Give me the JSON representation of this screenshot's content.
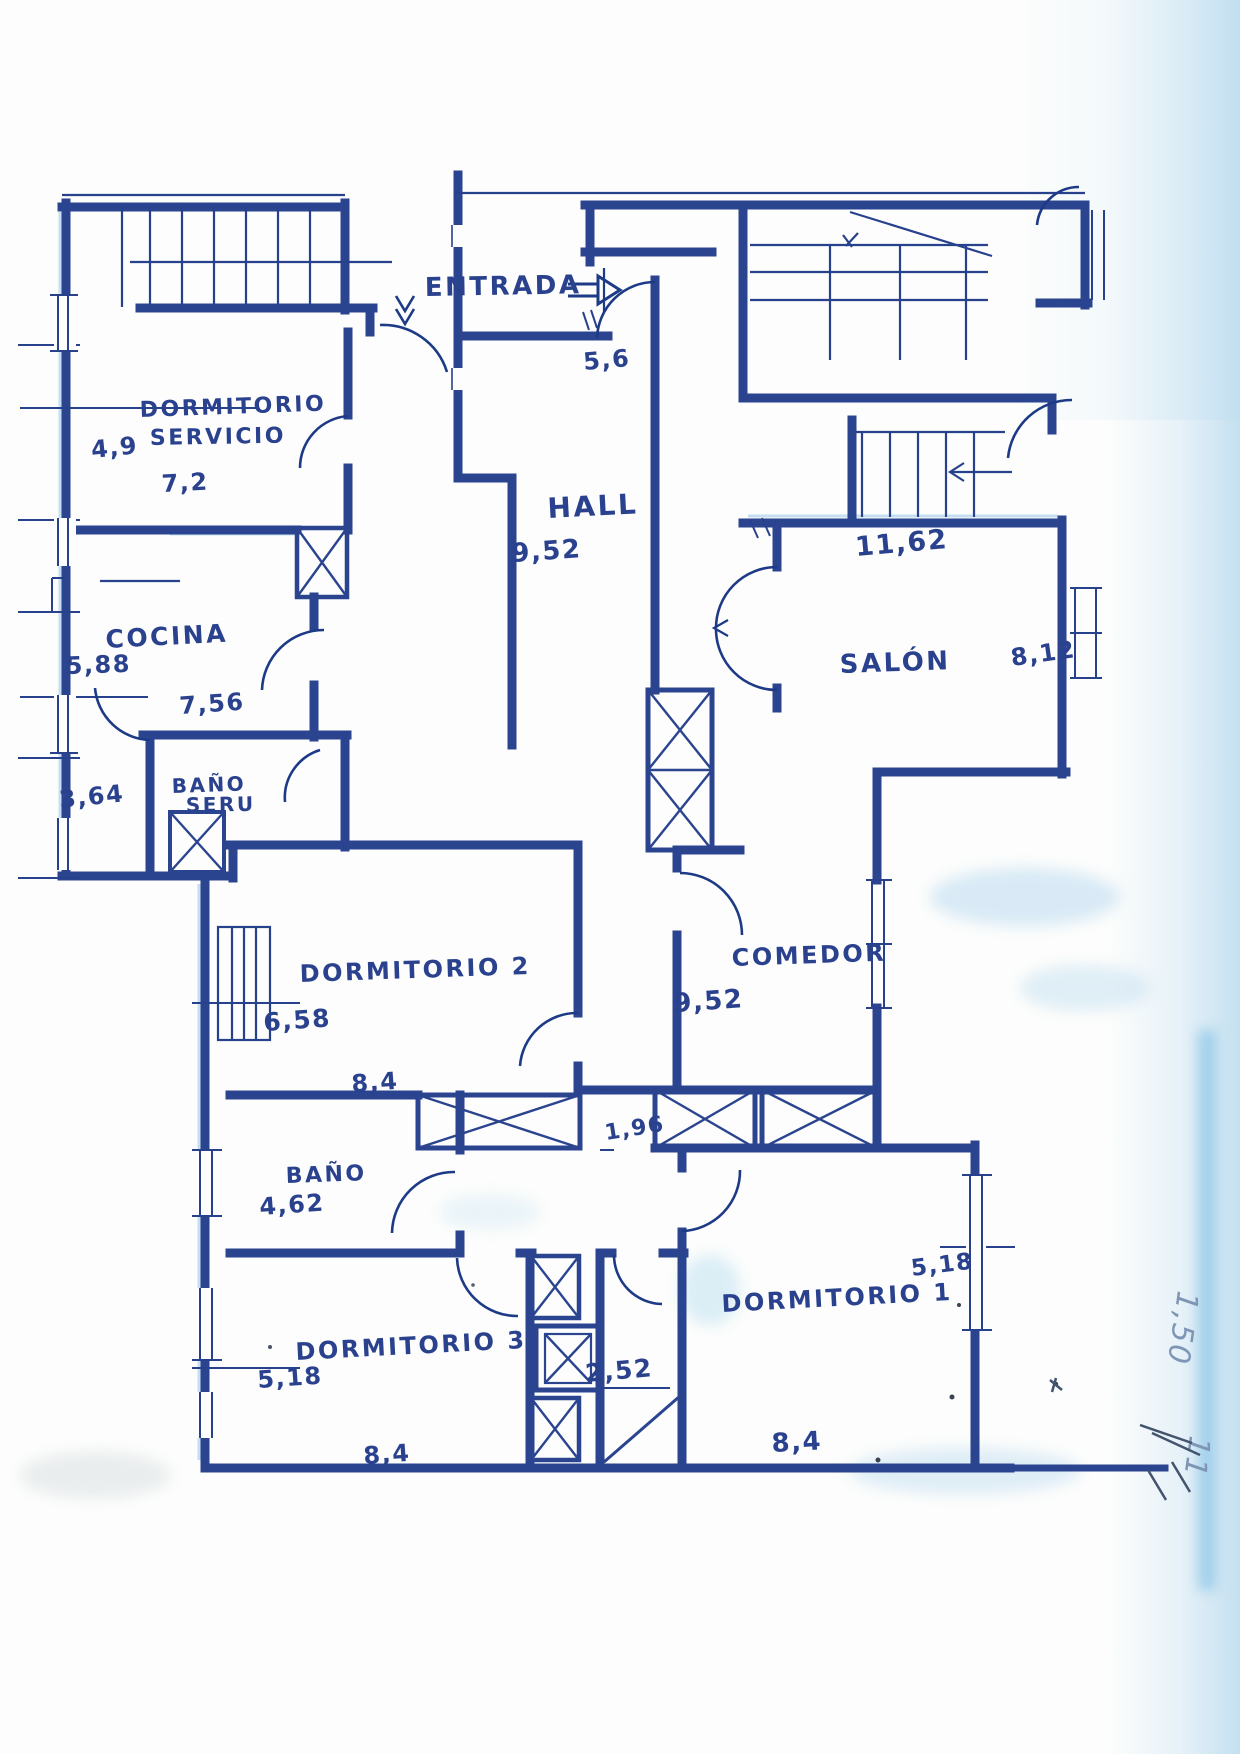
{
  "plan": {
    "rooms": {
      "dormitorio_servicio": {
        "label_line1": "DORMITORIO",
        "label_line2": "SERVICIO",
        "dim_width": "4,9",
        "dim_length": "7,2"
      },
      "cocina": {
        "label": "COCINA",
        "dim_width": "5,88",
        "dim_length": "7,56"
      },
      "bano_servicio": {
        "label_line1": "BAÑO",
        "label_line2": "SERU",
        "dim_width": "3,64"
      },
      "entrada": {
        "label": "ENTRADA",
        "dim_width": "5,6"
      },
      "hall": {
        "label": "HALL",
        "dim_length": "9,52"
      },
      "salon": {
        "label": "SALÓN",
        "dim_width": "11,62",
        "dim_depth": "8,12"
      },
      "comedor": {
        "label": "COMEDOR",
        "dim_length": "9,52",
        "dim_corridor": "1,96"
      },
      "dormitorio_2": {
        "label": "DORMITORIO 2",
        "dim_width": "6,58",
        "dim_length": "8,4"
      },
      "bano": {
        "label": "BAÑO",
        "dim_width": "4,62"
      },
      "dormitorio_3": {
        "label": "DORMITORIO 3",
        "dim_width": "5,18",
        "dim_length": "8,4"
      },
      "dormitorio_1": {
        "label": "DORMITORIO 1",
        "dim_width": "5,18",
        "dim_length": "8,4",
        "dim_shaft": "2,52"
      }
    },
    "annotations": {
      "margin_note_top": "1,50",
      "margin_note_bottom": "11"
    },
    "colors": {
      "ink": "#2a418e",
      "ink_dark": "#1d3a86",
      "paper": "#fcfdfc",
      "scan_tint": "#bcdcf0"
    }
  }
}
